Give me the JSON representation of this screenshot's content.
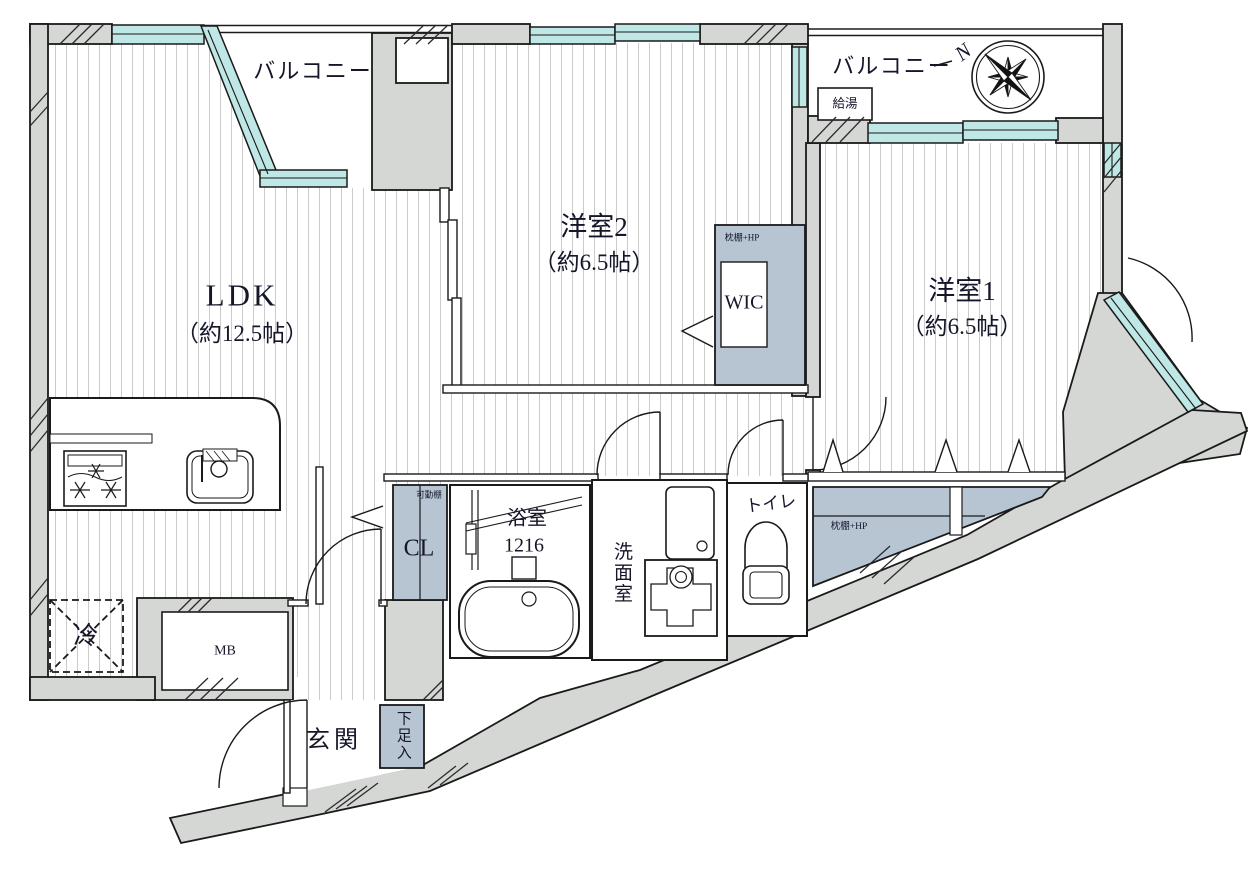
{
  "page": {
    "type": "Japanese apartment floor plan"
  },
  "rooms": {
    "ldk": {
      "name": "LDK",
      "size": "（約12.5帖）"
    },
    "bedroom2": {
      "name": "洋室2",
      "size": "（約6.5帖）"
    },
    "bedroom1": {
      "name": "洋室1",
      "size": "（約6.5帖）"
    },
    "balcony_left": {
      "name": "バルコニー"
    },
    "balcony_right": {
      "name": "バルコニー"
    },
    "wic": {
      "name": "WIC",
      "shelf_label": "枕棚+HP"
    },
    "closet_hall": {
      "name": "CL",
      "shelf_label": "可動棚"
    },
    "closet_bedroom1": {
      "shelf_label": "枕棚+HP"
    },
    "bathroom": {
      "name": "浴室",
      "size": "1216"
    },
    "washroom": {
      "name": "洗面室"
    },
    "toilet": {
      "name": "トイレ"
    },
    "entrance": {
      "name": "玄関"
    },
    "shoe_cabinet": {
      "name": "下足入"
    },
    "meter_box": {
      "name": "MB"
    },
    "refrigerator": {
      "name": "冷"
    },
    "water_heater": {
      "name": "給湯"
    }
  },
  "compass": {
    "north": "N"
  },
  "colors": {
    "wall": "#d5d7d4",
    "window": "#bfe7e5",
    "closet": "#b7c5d3",
    "floor_stripe": "#cbcbcb"
  }
}
